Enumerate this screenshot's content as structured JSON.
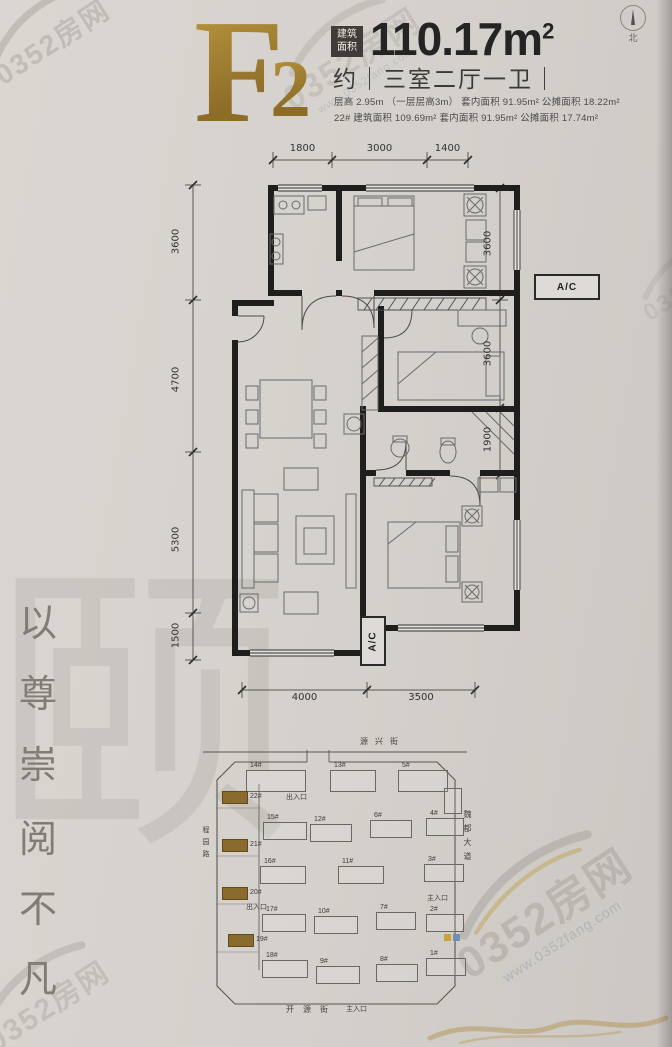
{
  "header": {
    "type_letter": "F",
    "type_number": "2",
    "area_badge": [
      "建筑",
      "面积"
    ],
    "area_value": "110.17",
    "area_unit": "m",
    "area_unit_sup": "2",
    "layout_line": "约｜三室二厅一卫｜",
    "spec_line_1": "层高 2.95m （一层层高3m） 套内面积 91.95m² 公摊面积 18.22m²",
    "spec_line_2": "22# 建筑面积 109.69m² 套内面积 91.95m² 公摊面积 17.74m²",
    "compass_north": "北"
  },
  "floorplan": {
    "ac_label_right": "A/C",
    "ac_label_bottom": "A/C",
    "dims_top": [
      "1800",
      "3000",
      "1400"
    ],
    "dims_left": [
      "3600",
      "4700",
      "5300",
      "1500"
    ],
    "dims_right": [
      "3600",
      "3600",
      "1900"
    ],
    "dims_bottom": [
      "4000",
      "3500"
    ]
  },
  "siteplan": {
    "street_top": "源兴街",
    "street_bottom": "开源街",
    "road_right": "魏都大道",
    "road_left": "程园路",
    "entrance_top": "出入口",
    "entrance_left": "出入口",
    "entrance_main_right": "主入口",
    "entrance_main_bottom": "主入口",
    "building_labels": [
      "14#",
      "13#",
      "5#",
      "22#",
      "21#",
      "20#",
      "19#",
      "15#",
      "12#",
      "6#",
      "4#",
      "16#",
      "11#",
      "3#",
      "17#",
      "10#",
      "7#",
      "2#",
      "18#",
      "9#",
      "8#",
      "1#"
    ],
    "accent_color": "#8a6b2e"
  },
  "slogan": {
    "chars": [
      "以",
      "尊",
      "崇",
      "阅",
      "不",
      "凡"
    ]
  },
  "watermark": {
    "brand": "0352房网",
    "url": "www.0352fang.com"
  },
  "decor": {
    "background_char": "颐"
  }
}
